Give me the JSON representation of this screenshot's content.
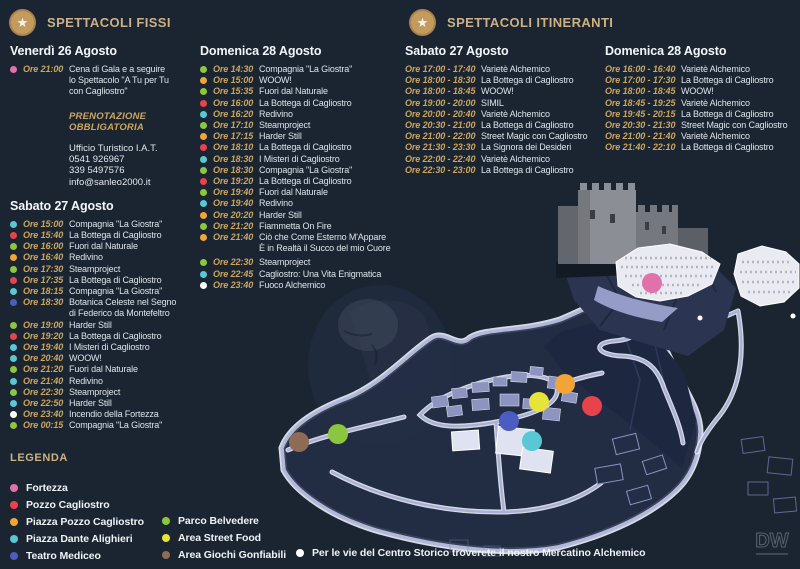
{
  "sections": [
    {
      "id": "fixed",
      "title": "SPETTACOLI FISSI",
      "days": [
        {
          "column": "colA",
          "date": "Venerdì 26 Agosto",
          "entries": [
            {
              "dot": "pink",
              "time": "Ore 21:00",
              "title": "Cena di Gala e a seguire\nlo Spettacolo \"A Tu per Tu\ncon Cagliostro\""
            }
          ],
          "note_lines": [
            "PRENOTAZIONE",
            "OBBLIGATORIA"
          ],
          "contact_lines": [
            "Ufficio Turistico I.A.T.",
            "0541 926967",
            "339 5497576",
            "info@sanleo2000.it"
          ]
        },
        {
          "column": "colA",
          "date": "Sabato 27 Agosto",
          "entries": [
            {
              "dot": "cyan",
              "time": "Ore 15:00",
              "title": "Compagnia \"La Giostra\""
            },
            {
              "dot": "red",
              "time": "Ore 15:40",
              "title": "La Bottega di Cagliostro"
            },
            {
              "dot": "green",
              "time": "Ore 16:00",
              "title": "Fuori dal Naturale"
            },
            {
              "dot": "orange",
              "time": "Ore 16:40",
              "title": "Redivino"
            },
            {
              "dot": "green",
              "time": "Ore 17:30",
              "title": "Steamproject"
            },
            {
              "dot": "red",
              "time": "Ore 17:35",
              "title": "La Bottega di Cagliostro"
            },
            {
              "dot": "cyan",
              "time": "Ore 18:15",
              "title": "Compagnia \"La Giostra\""
            },
            {
              "dot": "blue",
              "time": "Ore 18:30",
              "title": "Botanica Celeste nel Segno\ndi Federico da Montefeltro"
            },
            {
              "dot": "green",
              "time": "Ore 19:00",
              "title": "Harder Still"
            },
            {
              "dot": "red",
              "time": "Ore 19:20",
              "title": "La Bottega di Cagliostro"
            },
            {
              "dot": "cyan",
              "time": "Ore 19:40",
              "title": "I Misteri di Cagliostro"
            },
            {
              "dot": "cyan",
              "time": "Ore 20:40",
              "title": "WOOW!"
            },
            {
              "dot": "green",
              "time": "Ore 21:20",
              "title": "Fuori dal Naturale"
            },
            {
              "dot": "cyan",
              "time": "Ore 21:40",
              "title": "Redivino"
            },
            {
              "dot": "green",
              "time": "Ore 22:30",
              "title": "Steamproject"
            },
            {
              "dot": "cyan",
              "time": "Ore 22:50",
              "title": "Harder Still"
            },
            {
              "dot": "white",
              "time": "Ore 23:40",
              "title": "Incendio della Fortezza"
            },
            {
              "dot": "green",
              "time": "Ore 00:15",
              "title": "Compagnia \"La Giostra\""
            }
          ]
        },
        {
          "column": "colB",
          "date": "Domenica 28 Agosto",
          "entries": [
            {
              "dot": "green",
              "time": "Ore 14:30",
              "title": "Compagnia \"La Giostra\""
            },
            {
              "dot": "orange",
              "time": "Ore 15:00",
              "title": "WOOW!"
            },
            {
              "dot": "green",
              "time": "Ore 15:35",
              "title": "Fuori dal Naturale"
            },
            {
              "dot": "red",
              "time": "Ore 16:00",
              "title": "La Bottega di Cagliostro"
            },
            {
              "dot": "cyan",
              "time": "Ore 16:20",
              "title": "Redivino"
            },
            {
              "dot": "green",
              "time": "Ore 17:10",
              "title": "Steamproject"
            },
            {
              "dot": "orange",
              "time": "Ore 17:15",
              "title": "Harder Still"
            },
            {
              "dot": "red",
              "time": "Ore 18:10",
              "title": "La Bottega di Cagliostro"
            },
            {
              "dot": "cyan",
              "time": "Ore 18:30",
              "title": "I Misteri di Cagliostro"
            },
            {
              "dot": "green",
              "time": "Ore 18:30",
              "title": "Compagnia \"La Giostra\""
            },
            {
              "dot": "red",
              "time": "Ore 19:20",
              "title": "La Bottega di Cagliostro"
            },
            {
              "dot": "green",
              "time": "Ore 19:40",
              "title": "Fuori dal Naturale"
            },
            {
              "dot": "cyan",
              "time": "Ore 19:40",
              "title": "Redivino"
            },
            {
              "dot": "orange",
              "time": "Ore 20:20",
              "title": "Harder Still"
            },
            {
              "dot": "green",
              "time": "Ore 21:20",
              "title": "Fiammetta On Fire"
            },
            {
              "dot": "orange",
              "time": "Ore 21:40",
              "title": "Ciò che Come Esterno M'Appare\nÈ in Realtà il Succo del mio Cuore"
            },
            {
              "dot": "green",
              "time": "Ore 22:30",
              "title": "Steamproject",
              "gap": true
            },
            {
              "dot": "cyan",
              "time": "Ore 22:45",
              "title": "Cagliostro: Una Vita Enigmatica"
            },
            {
              "dot": "white",
              "time": "Ore 23:40",
              "title": "Fuoco Alchemico"
            }
          ]
        }
      ]
    },
    {
      "id": "itinerant",
      "title": "SPETTACOLI ITINERANTI",
      "days": [
        {
          "column": "colC",
          "date": "Sabato 27 Agosto",
          "entries": [
            {
              "time": "Ore 17:00 - 17:40",
              "title": "Varietè Alchemico"
            },
            {
              "time": "Ore 18:00 - 18:30",
              "title": "La Bottega di Cagliostro"
            },
            {
              "time": "Ore 18:00 - 18:45",
              "title": "WOOW!"
            },
            {
              "time": "Ore 19:00 - 20:00",
              "title": "SIMIL"
            },
            {
              "time": "Ore 20:00 - 20:40",
              "title": "Varietè Alchemico"
            },
            {
              "time": "Ore 20:30 - 21:00",
              "title": "La Bottega di Cagliostro"
            },
            {
              "time": "Ore 21:00 - 22:00",
              "title": "Street Magic con Cagliostro"
            },
            {
              "time": "Ore 21:30 - 23:30",
              "title": "La Signora dei Desideri"
            },
            {
              "time": "Ore 22:00 - 22:40",
              "title": "Varietè Alchemico"
            },
            {
              "time": "Ore 22:30 - 23:00",
              "title": "La Bottega di Cagliostro"
            }
          ]
        },
        {
          "column": "colD",
          "date": "Domenica 28 Agosto",
          "entries": [
            {
              "time": "Ore 16:00 - 16:40",
              "title": "Varietè Alchemico"
            },
            {
              "time": "Ore 17:00 - 17:30",
              "title": "La Bottega di Cagliostro"
            },
            {
              "time": "Ore 18:00 - 18:45",
              "title": "WOOW!"
            },
            {
              "time": "Ore 18:45 - 19:25",
              "title": "Varietè Alchemico"
            },
            {
              "time": "Ore 19:45 - 20:15",
              "title": "La Bottega di Cagliostro"
            },
            {
              "time": "Ore 20:30 - 21:30",
              "title": "Street Magic con Cagliostro"
            },
            {
              "time": "Ore 21:00 - 21:40",
              "title": "Varietè Alchemico"
            },
            {
              "time": "Ore 21:40 - 22:10",
              "title": "La Bottega di Cagliostro"
            }
          ]
        }
      ]
    }
  ],
  "legend": {
    "title": "LEGENDA",
    "columns": [
      [
        {
          "dot": "pink",
          "label": "Fortezza"
        },
        {
          "dot": "red",
          "label": "Pozzo Cagliostro"
        },
        {
          "dot": "orange",
          "label": "Piazza Pozzo Cagliostro"
        },
        {
          "dot": "cyan",
          "label": "Piazza Dante Alighieri"
        },
        {
          "dot": "blue",
          "label": "Teatro Mediceo"
        }
      ],
      [
        {
          "dot": "green",
          "label": "Parco Belvedere"
        },
        {
          "dot": "yellow",
          "label": "Area Street Food"
        },
        {
          "dot": "brown",
          "label": "Area Giochi Gonfiabili"
        }
      ]
    ],
    "note": "Per le vie del Centro Storico troverete il nostro Mercatino Alchemico"
  },
  "map": {
    "markers": [
      {
        "id": "fortezza",
        "dot": "pink",
        "x": 652,
        "y": 283
      },
      {
        "id": "pozzo-cagliostro",
        "dot": "red",
        "x": 592,
        "y": 406
      },
      {
        "id": "piazza-pozzo-cagliostro",
        "dot": "orange",
        "x": 565,
        "y": 384
      },
      {
        "id": "area-street-food",
        "dot": "yellow",
        "x": 539,
        "y": 402
      },
      {
        "id": "teatro-mediceo",
        "dot": "blue",
        "x": 509,
        "y": 421
      },
      {
        "id": "piazza-dante-alighieri",
        "dot": "cyan",
        "x": 532,
        "y": 441
      },
      {
        "id": "parco-belvedere",
        "dot": "green",
        "x": 338,
        "y": 434
      },
      {
        "id": "area-giochi-gonfiabili",
        "dot": "brown",
        "x": 299,
        "y": 442
      }
    ]
  },
  "watermark": {
    "monogram": "DW"
  },
  "colors": {
    "background": "#1b2531",
    "gold": "#cdb183",
    "time_gold": "#cda65e",
    "date_white": "#f3f6f8",
    "dots": {
      "pink": "#e071ab",
      "red": "#e8434d",
      "green": "#8cc63f",
      "orange": "#f0a536",
      "cyan": "#58c8d4",
      "blue": "#4b5dc0",
      "yellow": "#e6e339",
      "brown": "#8e6b55",
      "white": "#ffffff"
    }
  }
}
